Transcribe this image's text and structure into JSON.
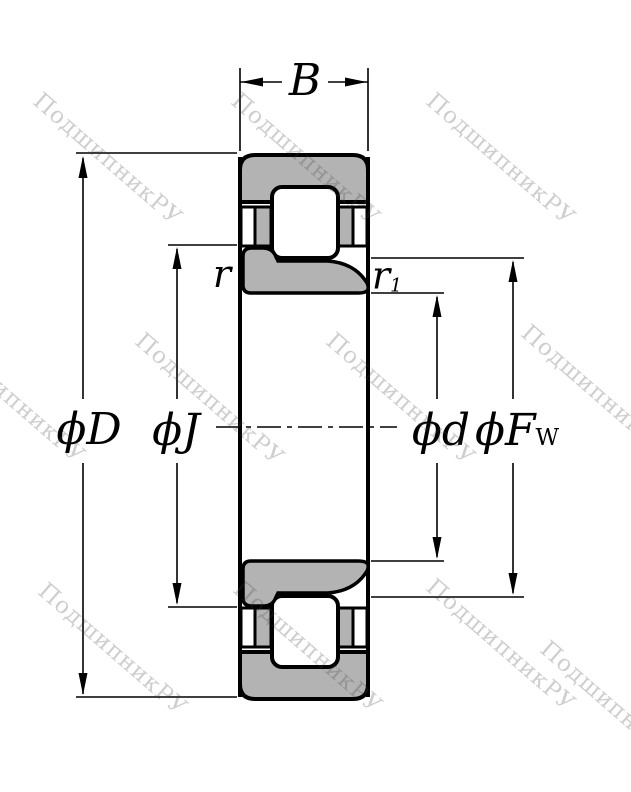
{
  "drawing": {
    "type": "bearing-cross-section",
    "ring_fill_color": "#b3b3b3",
    "line_color": "#000000",
    "background_color": "#ffffff"
  },
  "labels": {
    "width": "B",
    "outer_diameter": "ϕD",
    "rib_diameter": "ϕJ",
    "bore_diameter": "ϕd",
    "raceway_main": "ϕF",
    "raceway_sub": "W",
    "fillet": "r",
    "fillet1_main": "r",
    "fillet1_sub": "1"
  },
  "watermark": {
    "text": "ПодшипникРУ",
    "color": "rgba(60,60,60,0.25)",
    "positions": [
      {
        "x": 45,
        "y": 88
      },
      {
        "x": 243,
        "y": 88
      },
      {
        "x": 438,
        "y": 88
      },
      {
        "x": -52,
        "y": 326
      },
      {
        "x": 147,
        "y": 328
      },
      {
        "x": 338,
        "y": 328
      },
      {
        "x": 533,
        "y": 320
      },
      {
        "x": 50,
        "y": 578
      },
      {
        "x": 245,
        "y": 576
      },
      {
        "x": 438,
        "y": 574
      },
      {
        "x": 552,
        "y": 636
      }
    ]
  }
}
